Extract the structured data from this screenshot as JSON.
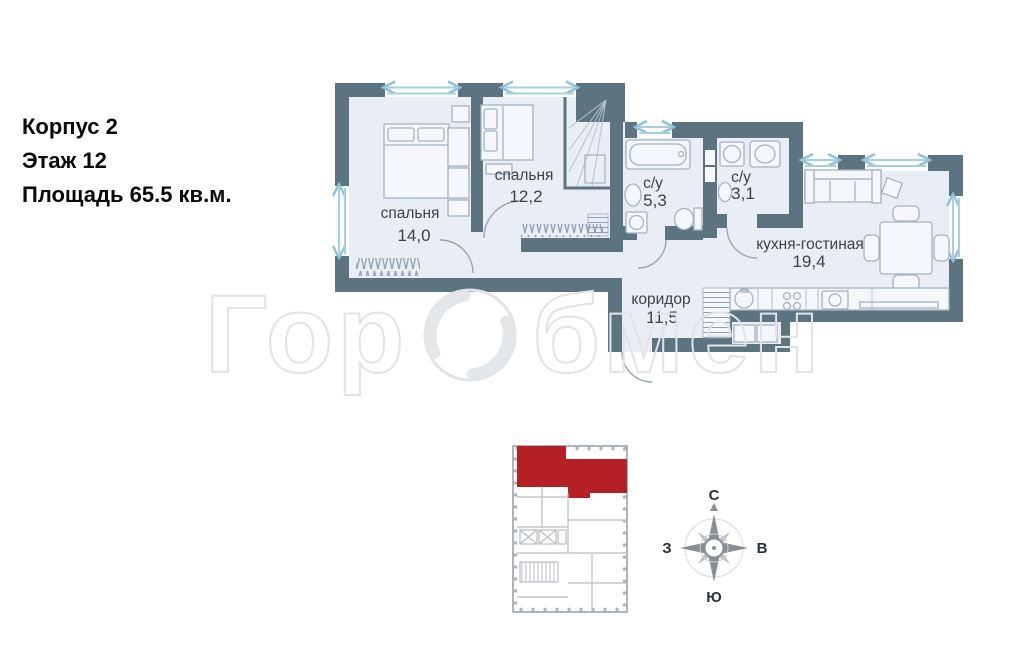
{
  "info": {
    "line1": "Корпус 2",
    "line2": "Этаж 12",
    "line3": "Площадь 65.5 кв.м."
  },
  "floorplan": {
    "rooms": [
      {
        "name": "спальня",
        "area": "14,0"
      },
      {
        "name": "спальня",
        "area": "12,2"
      },
      {
        "name": "с/у",
        "area": "5,3"
      },
      {
        "name": "с/у",
        "area": "3,1"
      },
      {
        "name": "кухня-гостиная",
        "area": "19,4"
      },
      {
        "name": "коридор",
        "area": "11,5"
      }
    ]
  },
  "compass": {
    "north": "С",
    "east": "В",
    "south": "Ю",
    "west": "З"
  },
  "watermark": {
    "left": "Гор",
    "right": "бмен"
  },
  "colors": {
    "wall": "#5b7480",
    "floor": "#e9edf5",
    "window": "#a9cede",
    "label": "#39434d",
    "red": "#b42025"
  }
}
